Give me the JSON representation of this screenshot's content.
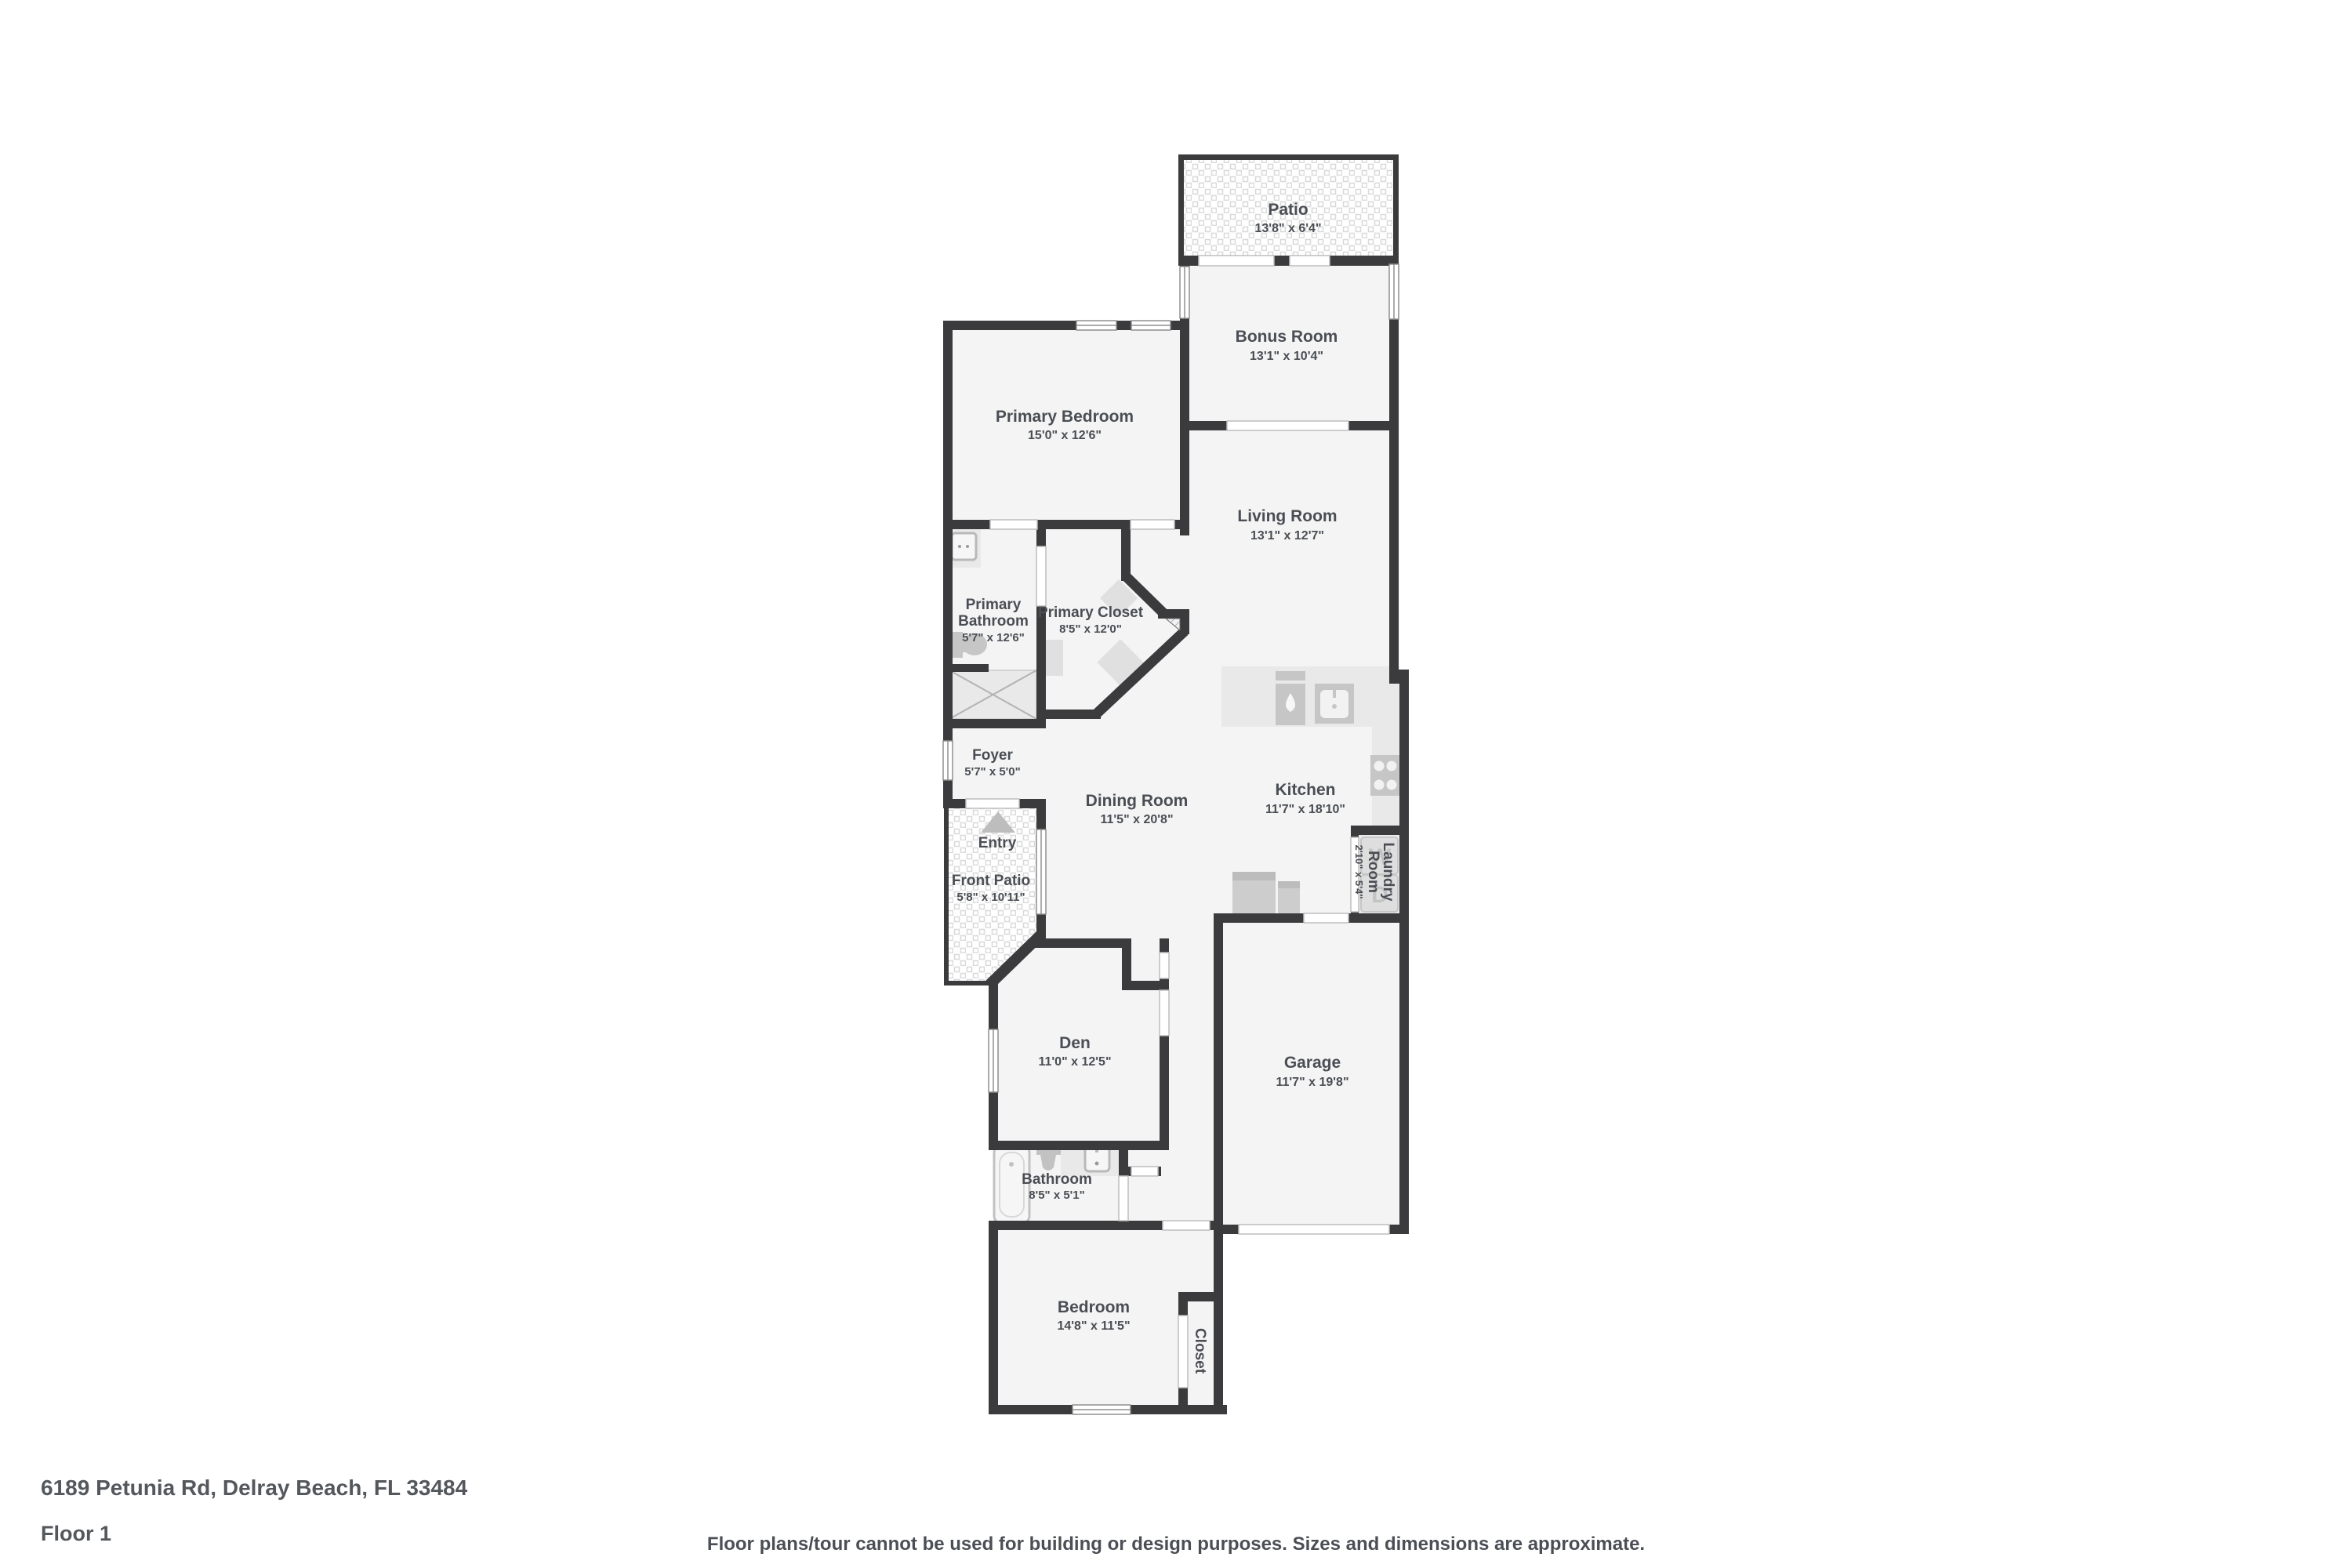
{
  "page": {
    "address": "6189 Petunia Rd, Delray Beach, FL 33484",
    "floor_label": "Floor 1",
    "disclaimer": "Floor plans/tour cannot be used for building or design purposes. Sizes and dimensions are approximate."
  },
  "colors": {
    "wall": "#3b3b3d",
    "room_fill": "#f4f4f4",
    "fixture_mid": "#c6c6c6",
    "fixture_light": "#e9e9e9",
    "label_text": "#4a4e54"
  },
  "rooms": {
    "patio": {
      "name": "Patio",
      "dims": "13'8\" x 6'4\""
    },
    "bonus_room": {
      "name": "Bonus Room",
      "dims": "13'1\" x 10'4\""
    },
    "primary_bedroom": {
      "name": "Primary Bedroom",
      "dims": "15'0\" x 12'6\""
    },
    "living_room": {
      "name": "Living Room",
      "dims": "13'1\" x 12'7\""
    },
    "primary_bathroom": {
      "name_line1": "Primary",
      "name_line2": "Bathroom",
      "dims": "5'7\" x 12'6\""
    },
    "primary_closet": {
      "name": "Primary Closet",
      "dims": "8'5\" x 12'0\""
    },
    "foyer": {
      "name": "Foyer",
      "dims": "5'7\" x 5'0\""
    },
    "entry": {
      "name": "Entry"
    },
    "front_patio": {
      "name": "Front Patio",
      "dims": "5'8\" x 10'11\""
    },
    "dining_room": {
      "name": "Dining Room",
      "dims": "11'5\" x 20'8\""
    },
    "kitchen": {
      "name": "Kitchen",
      "dims": "11'7\" x 18'10\""
    },
    "laundry_room": {
      "name_line1": "Laundry",
      "name_line2": "Room",
      "dims": "2'10\" x 5'4\""
    },
    "den": {
      "name": "Den",
      "dims": "11'0\" x 12'5\""
    },
    "garage": {
      "name": "Garage",
      "dims": "11'7\" x 19'8\""
    },
    "bathroom": {
      "name": "Bathroom",
      "dims": "8'5\" x 5'1\""
    },
    "bedroom": {
      "name": "Bedroom",
      "dims": "14'8\" x 11'5\""
    },
    "closet": {
      "name": "Closet"
    }
  },
  "appliances": {
    "washer_label": "W",
    "dryer_label": "D"
  }
}
